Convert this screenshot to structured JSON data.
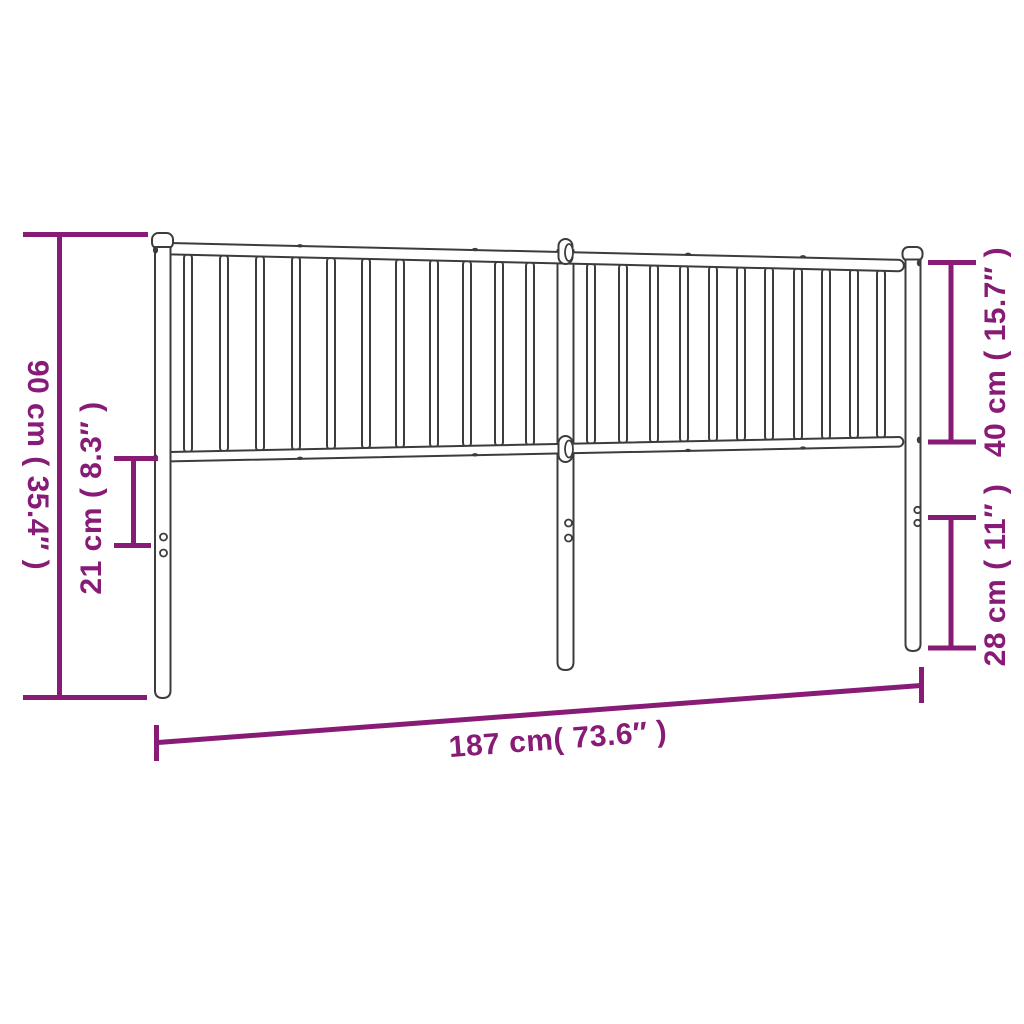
{
  "colors": {
    "dimension": "#871b76",
    "outline": "#3c3c3c",
    "background": "#ffffff"
  },
  "dimensions": {
    "left_total": "90 cm ( 35.4″ )",
    "left_inner": "21 cm ( 8.3″ )",
    "right_upper": "40 cm ( 15.7″ )",
    "right_lower": "28 cm ( 11″ )",
    "bottom_width": "187 cm( 73.6″ )"
  }
}
